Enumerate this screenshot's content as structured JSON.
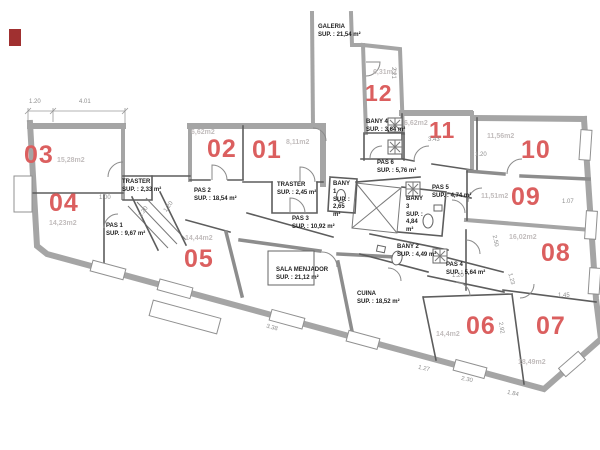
{
  "palette": {
    "room_number": "#db5f5f",
    "wall_gray": "#a5a5a5",
    "text_black": "#1f1f1f",
    "dim_gray": "#8e8e8e",
    "area_gray": "#c2bdbd",
    "marker_red": "#a03030"
  },
  "rooms": [
    {
      "number": "01",
      "area": "8,11m2"
    },
    {
      "number": "02",
      "area": "6,62m2"
    },
    {
      "number": "03",
      "area": "15,28m2"
    },
    {
      "number": "04",
      "area": "14,23m2"
    },
    {
      "number": "05",
      "area": "14,44m2"
    },
    {
      "number": "06",
      "area": "14,4m2"
    },
    {
      "number": "07",
      "area": "18,49m2"
    },
    {
      "number": "08",
      "area": "16,02m2"
    },
    {
      "number": "09",
      "area": "11,51m2"
    },
    {
      "number": "10",
      "area": "11,56m2"
    },
    {
      "number": "11",
      "area": "6,62m2"
    },
    {
      "number": "12",
      "area": "6,31m2"
    }
  ],
  "spaces": [
    {
      "name": "GALERIA",
      "sup": "SUP. : 21,54 m²"
    },
    {
      "name": "TRASTER",
      "sup": "SUP. : 2,33 m²"
    },
    {
      "name": "PAS 2",
      "sup": "SUP. : 18,54 m²"
    },
    {
      "name": "TRASTER",
      "sup": "SUP. : 2,45 m²"
    },
    {
      "name": "PAS 1",
      "sup": "SUP. : 9,67 m²"
    },
    {
      "name": "PAS 3",
      "sup": "SUP. : 10,92 m²"
    },
    {
      "name": "SALA MENJADOR",
      "sup": "SUP. : 21,12 m²"
    },
    {
      "name": "CUINA",
      "sup": "SUP. : 18,52 m²"
    },
    {
      "name": "BANY 4",
      "sup": "SUP. : 3,64 m²"
    },
    {
      "name": "PAS 6",
      "sup": "SUP. : 5,76 m²"
    },
    {
      "name": "BANY 1",
      "sup": "SUP. : 2,65 m²"
    },
    {
      "name": "BANY 3",
      "sup": "SUP. : 4,84 m²"
    },
    {
      "name": "PAS 5",
      "sup": "SUP. : 4,74 m²"
    },
    {
      "name": "BANY 2",
      "sup": "SUP. : 4,49 m²"
    },
    {
      "name": "PAS 4",
      "sup": "SUP. : 5,64 m²"
    }
  ],
  "dims": [
    "1.20",
    "4.01",
    "1.00",
    "1.20",
    "1.20",
    "2.21",
    "3.43",
    "1.20",
    "1.07",
    "2.50",
    "1.23",
    "1.45",
    "1.20",
    "3.38",
    "1.27",
    "2.30",
    "1.84",
    "2.92"
  ]
}
